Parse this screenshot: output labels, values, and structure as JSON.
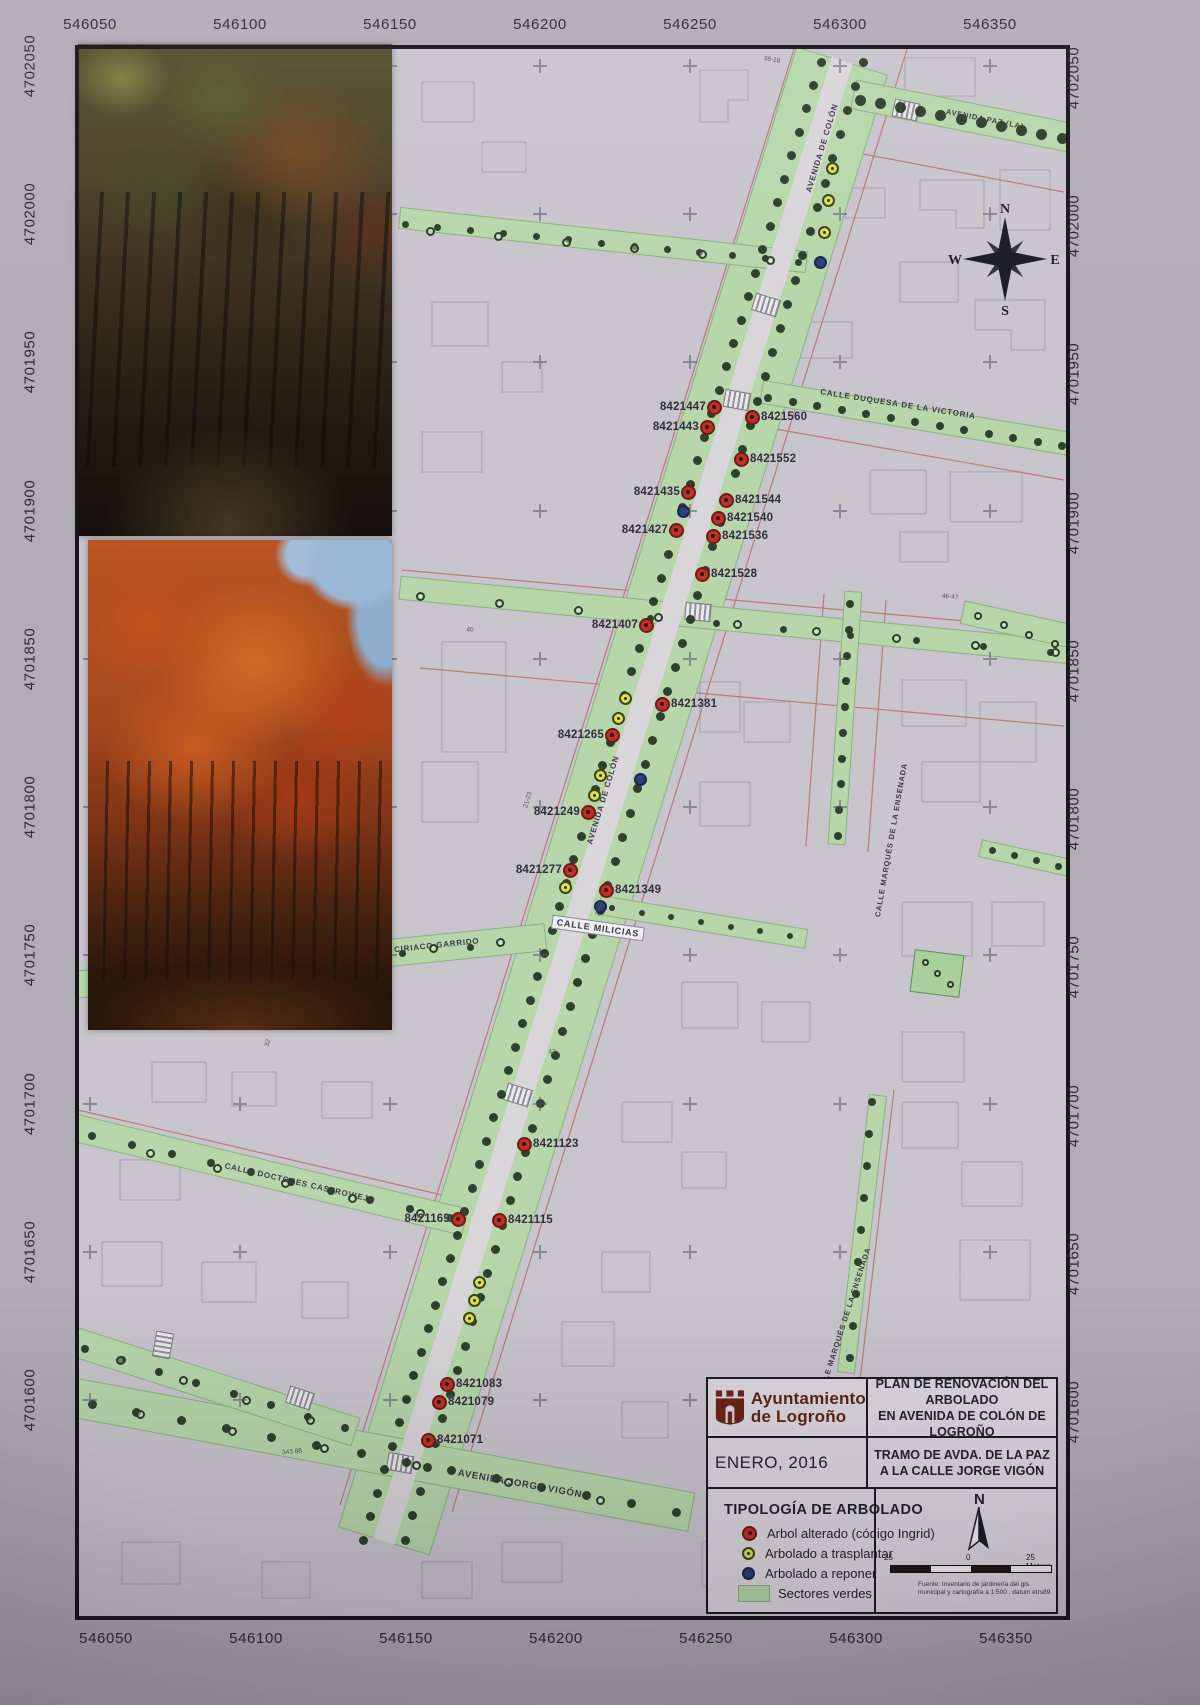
{
  "map": {
    "title_block": {
      "org1": "Ayuntamiento",
      "org2": "de Logroño",
      "plan1": "PLAN DE RENOVACIÓN DEL ARBOLADO",
      "plan2": "EN AVENIDA DE COLÓN DE LOGROÑO",
      "date": "ENERO, 2016",
      "tramo1": "TRAMO DE AVDA. DE LA PAZ",
      "tramo2": "A LA CALLE JORGE VIGÓN"
    },
    "legend": {
      "title": "TIPOLOGÍA DE ARBOLADO",
      "items": [
        {
          "type": "alterado",
          "label": "Arbol alterado (código Ingrid)",
          "color": "#bb3328"
        },
        {
          "type": "trasplantar",
          "label": "Arbolado a trasplantar",
          "color": "#d9e14b"
        },
        {
          "type": "reponer",
          "label": "Arbolado a reponer",
          "color": "#2a4076"
        },
        {
          "type": "sectores",
          "label": "Sectores verdes",
          "color": "#b7d7ab"
        }
      ],
      "north_label": "N",
      "scale": {
        "left": "25",
        "mid": "0",
        "right": "25 Meters"
      },
      "fuente1": "Fuente: Inventario de jardinería del gis",
      "fuente2": "municipal y cartografía a 1:500 , datum etrs89 (Logroño)"
    },
    "compass": {
      "n": "N",
      "e": "E",
      "s": "S",
      "w": "W"
    },
    "axes": {
      "x_labels": [
        "546050",
        "546100",
        "546150",
        "546200",
        "546250",
        "546300",
        "546350"
      ],
      "x_positions": [
        90,
        240,
        390,
        540,
        690,
        840,
        990
      ],
      "y_labels": [
        "4702050",
        "4702000",
        "4701950",
        "4701900",
        "4701850",
        "4701800",
        "4701750",
        "4701700",
        "4701650",
        "4701600"
      ],
      "y_positions": [
        66,
        214,
        362,
        511,
        659,
        807,
        955,
        1104,
        1252,
        1400
      ]
    },
    "streets": [
      {
        "name": "avenida-de-colon",
        "cx": 613,
        "cy": 801,
        "len": 1550,
        "w": 96,
        "rot": -72.8,
        "kind": "green"
      },
      {
        "name": "avenida-de-colon-road",
        "cx": 613,
        "cy": 801,
        "len": 1550,
        "w": 22,
        "rot": -72.8,
        "kind": "road"
      },
      {
        "name": "avenida-paz",
        "cx": 962,
        "cy": 116,
        "len": 222,
        "w": 30,
        "rot": 11.3,
        "kind": "green"
      },
      {
        "name": "calle-duquesa-de-la-victoria",
        "cx": 916,
        "cy": 418,
        "len": 315,
        "w": 24,
        "rot": 9.6,
        "kind": "green"
      },
      {
        "name": "upper-left-street",
        "cx": 603,
        "cy": 240,
        "len": 410,
        "w": 22,
        "rot": 6.2,
        "kind": "green"
      },
      {
        "name": "mid-cross-street",
        "cx": 735,
        "cy": 620,
        "len": 675,
        "w": 24,
        "rot": 5.5,
        "kind": "green"
      },
      {
        "name": "calle-milicias",
        "cx": 703,
        "cy": 922,
        "len": 210,
        "w": 20,
        "rot": 9.3,
        "kind": "green"
      },
      {
        "name": "calle-ciriaco-garrido",
        "cx": 310,
        "cy": 961,
        "len": 474,
        "w": 28,
        "rot": -5.8,
        "kind": "green"
      },
      {
        "name": "calle-doctores-castroviejo",
        "cx": 270,
        "cy": 1175,
        "len": 402,
        "w": 28,
        "rot": 13.6,
        "kind": "green"
      },
      {
        "name": "avenida-jorge-vigon",
        "cx": 383,
        "cy": 1455,
        "len": 628,
        "w": 40,
        "rot": 10.5,
        "kind": "green"
      },
      {
        "name": "lower-left-street",
        "cx": 215,
        "cy": 1387,
        "len": 296,
        "w": 30,
        "rot": 17.8,
        "kind": "green"
      },
      {
        "name": "calle-marques-ensenada-norte",
        "cx": 845,
        "cy": 718,
        "len": 254,
        "w": 18,
        "rot": -86.2,
        "kind": "green"
      },
      {
        "name": "calle-marques-ensenada-sur",
        "cx": 862,
        "cy": 1234,
        "len": 280,
        "w": 18,
        "rot": -83.4,
        "kind": "green"
      },
      {
        "name": "right-mid-street",
        "cx": 1016,
        "cy": 624,
        "len": 110,
        "w": 24,
        "rot": 12.5,
        "kind": "green"
      },
      {
        "name": "right-lower-street",
        "cx": 1025,
        "cy": 858,
        "len": 92,
        "w": 18,
        "rot": 12.5,
        "kind": "green"
      },
      {
        "name": "park-square",
        "cx": 937,
        "cy": 973,
        "len": 50,
        "w": 43,
        "rot": 7,
        "kind": "park"
      }
    ],
    "street_labels": [
      {
        "text": "AVENIDA DE COLÓN",
        "x": 822,
        "y": 148,
        "rot": -73,
        "size": 8
      },
      {
        "text": "AVENIDA DE COLÓN",
        "x": 603,
        "y": 800,
        "rot": -73,
        "size": 8
      },
      {
        "text": "AVENIDA PAZ (LA)",
        "x": 985,
        "y": 119,
        "rot": 11,
        "size": 7.5
      },
      {
        "text": "CALLE DUQUESA DE LA VICTORIA",
        "x": 898,
        "y": 404,
        "rot": 9,
        "size": 8
      },
      {
        "text": "CALLE MILICIAS",
        "x": 598,
        "y": 928,
        "rot": 8,
        "size": 9,
        "bg": true
      },
      {
        "text": "CALLE CIRIACO GARRIDO",
        "x": 420,
        "y": 947,
        "rot": -6,
        "size": 8
      },
      {
        "text": "CALLE DOCTORES CASTROVIEJO",
        "x": 300,
        "y": 1183,
        "rot": 13,
        "size": 8
      },
      {
        "text": "AVENIDA JORGE VIGÓN",
        "x": 520,
        "y": 1484,
        "rot": 10,
        "size": 9.5
      },
      {
        "text": "CALLE MARQUÉS DE LA ENSENADA",
        "x": 891,
        "y": 840,
        "rot": -80,
        "size": 7.5
      },
      {
        "text": "LLE MARQUÉS DE LA ENSENADA",
        "x": 846,
        "y": 1316,
        "rot": -72,
        "size": 7.5
      }
    ],
    "crosswalks": [
      {
        "x": 766,
        "y": 305,
        "rot": 17
      },
      {
        "x": 737,
        "y": 400,
        "rot": 10
      },
      {
        "x": 906,
        "y": 110,
        "rot": 12
      },
      {
        "x": 698,
        "y": 612,
        "rot": 5
      },
      {
        "x": 518,
        "y": 1095,
        "rot": 17
      },
      {
        "x": 400,
        "y": 1463,
        "rot": 10
      },
      {
        "x": 300,
        "y": 1398,
        "rot": 18
      },
      {
        "x": 163,
        "y": 1345,
        "rot": 100
      }
    ],
    "dot_chains": [
      {
        "x1": 821,
        "y1": 62,
        "x2": 363,
        "y2": 1540,
        "n": 64,
        "kind": "dot",
        "r": 4.5
      },
      {
        "x1": 863,
        "y1": 62,
        "x2": 405,
        "y2": 1540,
        "n": 62,
        "kind": "dot",
        "r": 4.5
      },
      {
        "x1": 860,
        "y1": 100,
        "x2": 1062,
        "y2": 138,
        "n": 11,
        "kind": "dot",
        "r": 5.5
      },
      {
        "x1": 768,
        "y1": 398,
        "x2": 1062,
        "y2": 446,
        "n": 13,
        "kind": "dot",
        "r": 4
      },
      {
        "x1": 405,
        "y1": 224,
        "x2": 798,
        "y2": 262,
        "n": 13,
        "kind": "dot",
        "r": 3.5
      },
      {
        "x1": 430,
        "y1": 231,
        "x2": 770,
        "y2": 260,
        "n": 6,
        "kind": "ring",
        "r": 4.5
      },
      {
        "x1": 420,
        "y1": 596,
        "x2": 1055,
        "y2": 652,
        "n": 9,
        "kind": "ring",
        "r": 4.5
      },
      {
        "x1": 650,
        "y1": 618,
        "x2": 1050,
        "y2": 652,
        "n": 7,
        "kind": "dot",
        "r": 3.5
      },
      {
        "x1": 850,
        "y1": 604,
        "x2": 838,
        "y2": 836,
        "n": 10,
        "kind": "dot",
        "r": 4
      },
      {
        "x1": 100,
        "y1": 981,
        "x2": 500,
        "y2": 942,
        "n": 7,
        "kind": "ring",
        "r": 4.5
      },
      {
        "x1": 130,
        "y1": 977,
        "x2": 470,
        "y2": 947,
        "n": 6,
        "kind": "dot",
        "r": 3.5
      },
      {
        "x1": 92,
        "y1": 1136,
        "x2": 450,
        "y2": 1218,
        "n": 10,
        "kind": "dot",
        "r": 4
      },
      {
        "x1": 150,
        "y1": 1153,
        "x2": 420,
        "y2": 1213,
        "n": 5,
        "kind": "ring",
        "r": 4.5
      },
      {
        "x1": 92,
        "y1": 1404,
        "x2": 676,
        "y2": 1512,
        "n": 14,
        "kind": "dot",
        "r": 4.5
      },
      {
        "x1": 140,
        "y1": 1414,
        "x2": 600,
        "y2": 1500,
        "n": 6,
        "kind": "ring",
        "r": 4.5
      },
      {
        "x1": 85,
        "y1": 1349,
        "x2": 345,
        "y2": 1428,
        "n": 8,
        "kind": "dot",
        "r": 4
      },
      {
        "x1": 120,
        "y1": 1360,
        "x2": 310,
        "y2": 1420,
        "n": 4,
        "kind": "ring",
        "r": 4.5
      },
      {
        "x1": 612,
        "y1": 908,
        "x2": 790,
        "y2": 936,
        "n": 7,
        "kind": "dot",
        "r": 3
      },
      {
        "x1": 978,
        "y1": 616,
        "x2": 1055,
        "y2": 644,
        "n": 4,
        "kind": "ring",
        "r": 4
      },
      {
        "x1": 872,
        "y1": 1102,
        "x2": 850,
        "y2": 1358,
        "n": 9,
        "kind": "dot",
        "r": 4
      },
      {
        "x1": 992,
        "y1": 850,
        "x2": 1058,
        "y2": 866,
        "n": 4,
        "kind": "dot",
        "r": 3.5
      },
      {
        "x1": 925,
        "y1": 962,
        "x2": 950,
        "y2": 984,
        "n": 3,
        "kind": "ring",
        "r": 3.5
      }
    ],
    "extra_markers": [
      {
        "type": "yellow",
        "x": 832,
        "y": 168
      },
      {
        "type": "yellow",
        "x": 828,
        "y": 200
      },
      {
        "type": "yellow",
        "x": 824,
        "y": 232
      },
      {
        "type": "yellow",
        "x": 625,
        "y": 698
      },
      {
        "type": "yellow",
        "x": 618,
        "y": 718
      },
      {
        "type": "yellow",
        "x": 600,
        "y": 775
      },
      {
        "type": "yellow",
        "x": 594,
        "y": 795
      },
      {
        "type": "yellow",
        "x": 565,
        "y": 887
      },
      {
        "type": "yellow",
        "x": 479,
        "y": 1282
      },
      {
        "type": "yellow",
        "x": 474,
        "y": 1300
      },
      {
        "type": "yellow",
        "x": 469,
        "y": 1318
      },
      {
        "type": "blue",
        "x": 820,
        "y": 262
      },
      {
        "type": "blue",
        "x": 683,
        "y": 511
      },
      {
        "type": "blue",
        "x": 640,
        "y": 779
      },
      {
        "type": "blue",
        "x": 600,
        "y": 906
      }
    ],
    "tree_markers": [
      {
        "id": "8421447",
        "x": 714,
        "y": 407,
        "side": "L"
      },
      {
        "id": "8421443",
        "x": 707,
        "y": 427,
        "side": "L"
      },
      {
        "id": "8421435",
        "x": 688,
        "y": 492,
        "side": "L"
      },
      {
        "id": "8421427",
        "x": 676,
        "y": 530,
        "side": "L"
      },
      {
        "id": "8421407",
        "x": 646,
        "y": 625,
        "side": "L"
      },
      {
        "id": "8421265",
        "x": 612,
        "y": 735,
        "side": "L"
      },
      {
        "id": "8421249",
        "x": 588,
        "y": 812,
        "side": "L"
      },
      {
        "id": "8421277",
        "x": 570,
        "y": 870,
        "side": "L"
      },
      {
        "id": "8421169",
        "x": 458,
        "y": 1219,
        "side": "L"
      },
      {
        "id": "8421560",
        "x": 752,
        "y": 417,
        "side": "R"
      },
      {
        "id": "8421552",
        "x": 741,
        "y": 459,
        "side": "R"
      },
      {
        "id": "8421544",
        "x": 726,
        "y": 500,
        "side": "R"
      },
      {
        "id": "8421540",
        "x": 718,
        "y": 518,
        "side": "R"
      },
      {
        "id": "8421536",
        "x": 713,
        "y": 536,
        "side": "R"
      },
      {
        "id": "8421528",
        "x": 702,
        "y": 574,
        "side": "R"
      },
      {
        "id": "8421381",
        "x": 662,
        "y": 704,
        "side": "R"
      },
      {
        "id": "8421349",
        "x": 606,
        "y": 890,
        "side": "R"
      },
      {
        "id": "8421123",
        "x": 524,
        "y": 1144,
        "side": "R"
      },
      {
        "id": "8421115",
        "x": 499,
        "y": 1220,
        "side": "R"
      },
      {
        "id": "8421083",
        "x": 447,
        "y": 1384,
        "side": "R"
      },
      {
        "id": "8421079",
        "x": 439,
        "y": 1402,
        "side": "R"
      },
      {
        "id": "8421071",
        "x": 428,
        "y": 1440,
        "side": "R"
      }
    ],
    "annotations": [
      {
        "text": "343 88",
        "x": 292,
        "y": 1452,
        "rot": -6
      },
      {
        "text": "38-18",
        "x": 772,
        "y": 60,
        "rot": 10
      },
      {
        "text": "46-47",
        "x": 950,
        "y": 597,
        "rot": 6
      },
      {
        "text": "21-23",
        "x": 528,
        "y": 800,
        "rot": -73
      },
      {
        "text": "27-29",
        "x": 600,
        "y": 908,
        "rot": -73
      },
      {
        "text": "40",
        "x": 470,
        "y": 630,
        "rot": 0
      },
      {
        "text": "42",
        "x": 552,
        "y": 1052,
        "rot": 0
      },
      {
        "text": "32",
        "x": 268,
        "y": 1043,
        "rot": -75
      }
    ]
  }
}
